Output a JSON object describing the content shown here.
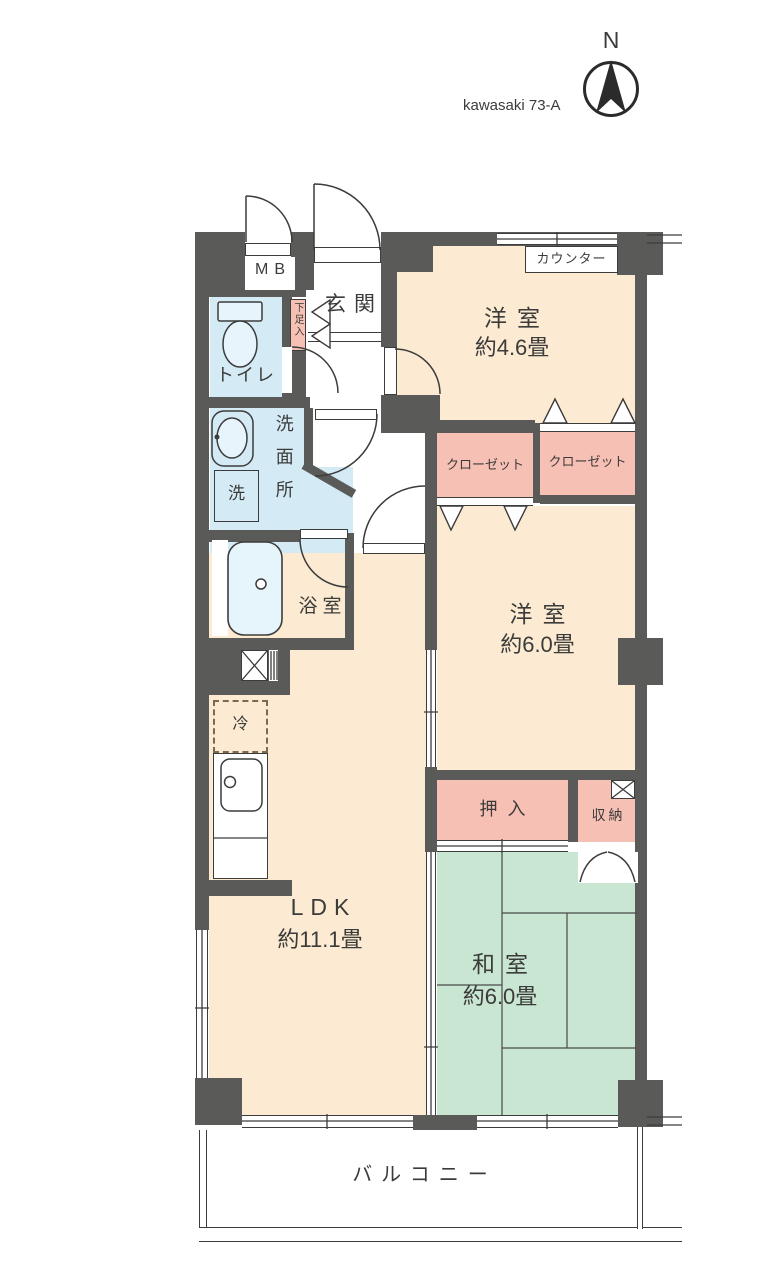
{
  "header": {
    "plan_code": "kawasaki 73-A",
    "compass_n": "N"
  },
  "labels": {
    "mb": "MB",
    "genkan": "玄関",
    "shoe_box": "下足入",
    "toilet": "トイレ",
    "washroom": "洗面所",
    "laundry": "洗",
    "bath": "浴室",
    "western1_name": "洋室",
    "western1_size": "約4.6畳",
    "counter": "カウンター",
    "closet_left": "クローゼット",
    "closet_right": "クローゼット",
    "western2_name": "洋室",
    "western2_size": "約6.0畳",
    "oshiire": "押入",
    "storage": "収納",
    "fridge": "冷",
    "ldk_name": "LDK",
    "ldk_size": "約11.1畳",
    "washitsu_name": "和室",
    "washitsu_size": "約6.0畳",
    "balcony": "バルコニー"
  },
  "colors": {
    "wall": "#5a5a58",
    "line": "#3c3c3c",
    "room_cream": "#fcebd2",
    "room_blue": "#d4ebf6",
    "room_pink": "#f7c0b4",
    "room_green": "#c8e6d2"
  }
}
